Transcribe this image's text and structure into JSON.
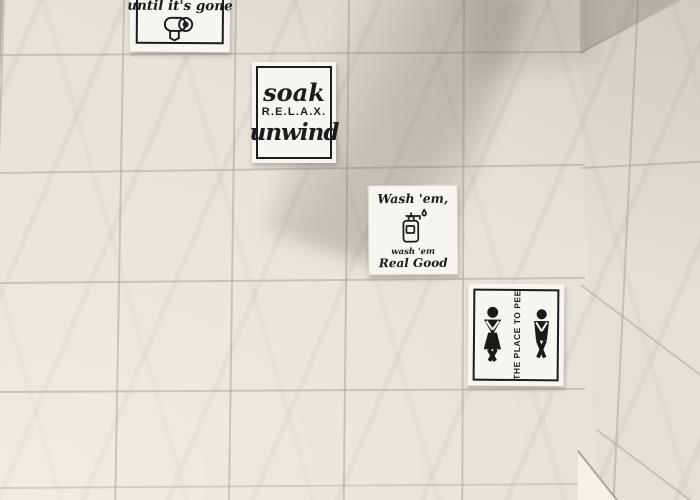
{
  "signs": {
    "toilet_paper_sign": {
      "text": "until it's gone",
      "icon": "toilet-paper-roll-icon"
    },
    "soak_sign": {
      "line1": "soak",
      "line2": "R.E.L.A.X.",
      "line3": "unwind"
    },
    "wash_sign": {
      "heading": "Wash 'em,",
      "icon": "soap-dispenser-icon",
      "footer_line1": "wash 'em",
      "footer_line2": "Real Good"
    },
    "pee_sign": {
      "vertical_text": "THE PLACE TO PEE",
      "left_icon": "woman-crossed-legs-icon",
      "right_icon": "man-crossed-legs-icon"
    }
  },
  "colors": {
    "tile": "#e7e3db",
    "grout": "#b1aca1",
    "card": "#f7f5ef",
    "ink": "#1c1c1c",
    "ledge": "#f3f1ea"
  }
}
